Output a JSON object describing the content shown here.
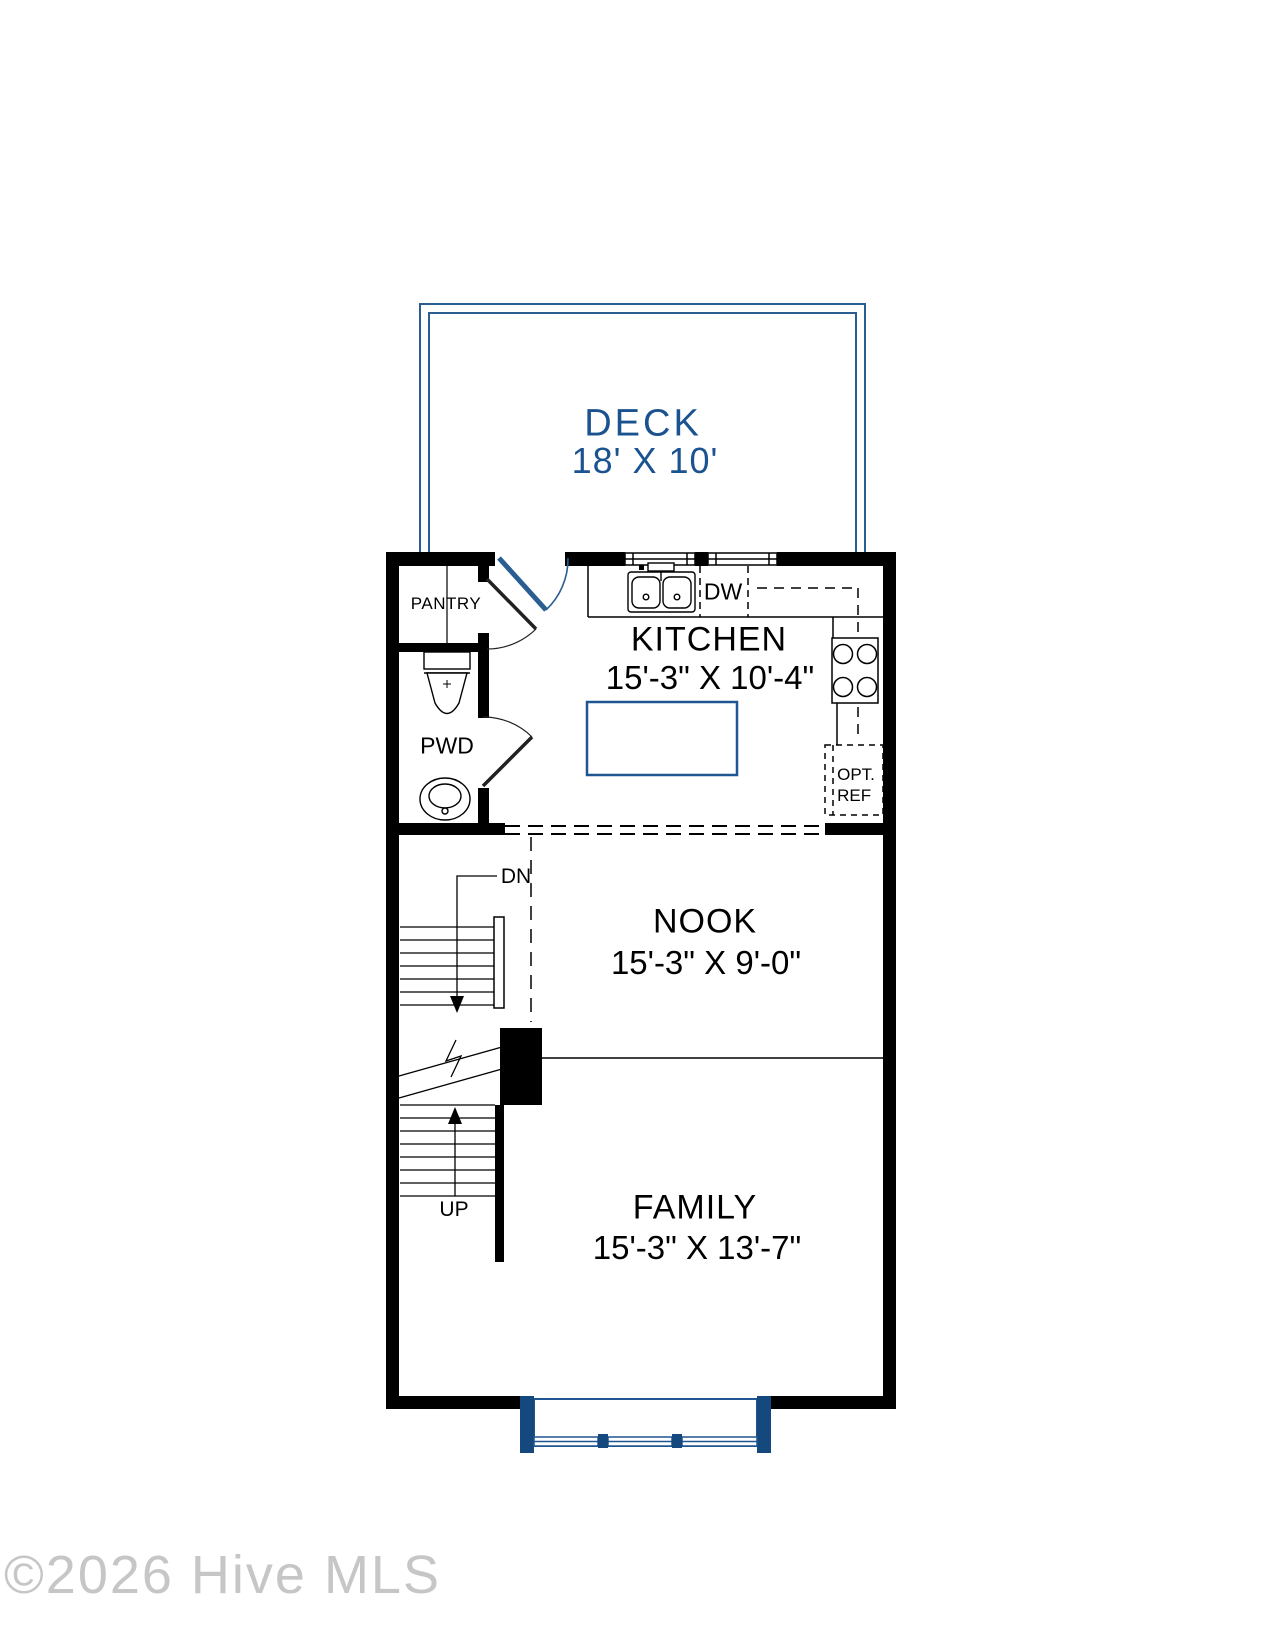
{
  "watermark": "©2026 Hive MLS",
  "colors": {
    "blue_line": "#1f5590",
    "blue_fill": "#15497e",
    "blue_text": "#1b5390",
    "wall": "#000000"
  },
  "rooms": {
    "deck": {
      "name": "DECK",
      "dims": "18' X 10'"
    },
    "kitchen": {
      "name": "KITCHEN",
      "dims": "15'-3\" X 10'-4\""
    },
    "nook": {
      "name": "NOOK",
      "dims": "15'-3\" X 9'-0\""
    },
    "family": {
      "name": "FAMILY",
      "dims": "15'-3\" X 13'-7\""
    },
    "pantry": {
      "name": "PANTRY"
    },
    "powder": {
      "name": "PWD"
    }
  },
  "labels": {
    "dishwasher": "DW",
    "opt_ref_line1": "OPT.",
    "opt_ref_line2": "REF",
    "stairs_down": "DN",
    "stairs_up": "UP"
  }
}
